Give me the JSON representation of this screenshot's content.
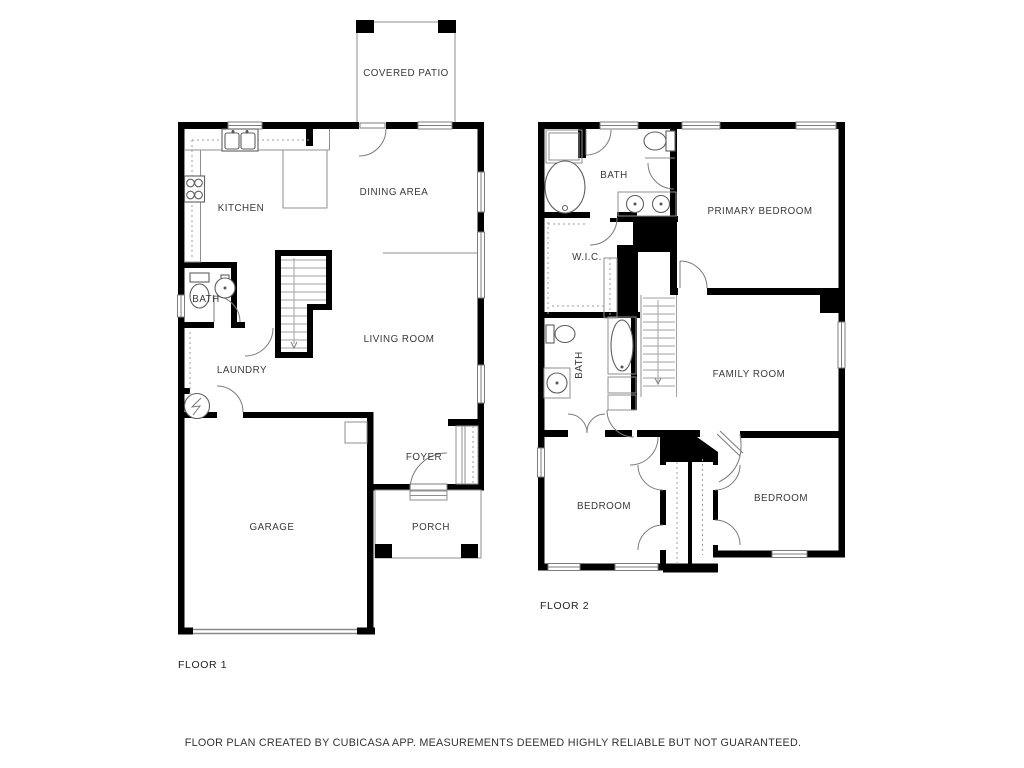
{
  "floor1": {
    "label": "FLOOR 1",
    "rooms": {
      "covered_patio": "COVERED PATIO",
      "kitchen": "KITCHEN",
      "dining_area": "DINING AREA",
      "bath": "BATH",
      "living_room": "LIVING ROOM",
      "laundry": "LAUNDRY",
      "foyer": "FOYER",
      "garage": "GARAGE",
      "porch": "PORCH"
    }
  },
  "floor2": {
    "label": "FLOOR 2",
    "rooms": {
      "bath": "BATH",
      "primary_bedroom": "PRIMARY BEDROOM",
      "wic": "W.I.C.",
      "family_room": "FAMILY ROOM",
      "bath2": "BATH",
      "bedroom_left": "BEDROOM",
      "bedroom_right": "BEDROOM"
    }
  },
  "footer": {
    "disclaimer": "FLOOR PLAN CREATED BY CUBICASA APP. MEASUREMENTS DEEMED HIGHLY RELIABLE BUT NOT GUARANTEED."
  }
}
